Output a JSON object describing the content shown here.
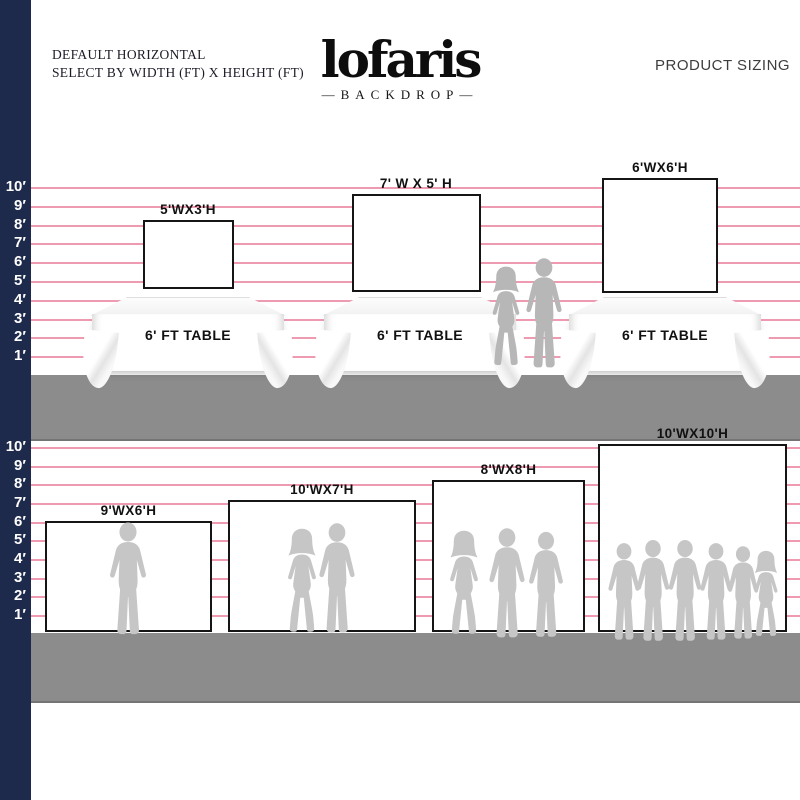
{
  "header": {
    "tagline_line1": "DEFAULT HORIZONTAL",
    "tagline_line2": "SELECT BY WIDTH (FT) X HEIGHT (FT)",
    "logo_text": "lofaris",
    "logo_sub": "—BACKDROP—",
    "right_label": "PRODUCT SIZING"
  },
  "ruler": {
    "unit": "ft",
    "labels": [
      "10′",
      "9′",
      "8′",
      "7′",
      "6′",
      "5′",
      "4′",
      "3′",
      "2′",
      "1′"
    ]
  },
  "colors": {
    "navy_bar": "#1e2a4c",
    "pink_line": "#ee9ab0",
    "floor_gray": "#8c8c8c",
    "silhouette_gray": "#c6c6c6",
    "silhouette_gray_dark": "#b7b7b7"
  },
  "top_section": {
    "table_label": "6' FT TABLE",
    "backdrops": [
      {
        "label": "5'WX3'H",
        "width_ft": 5,
        "height_ft": 3
      },
      {
        "label": "7' W X 5' H",
        "width_ft": 7,
        "height_ft": 5
      },
      {
        "label": "6'WX6'H",
        "width_ft": 6,
        "height_ft": 6
      }
    ]
  },
  "bottom_section": {
    "backdrops": [
      {
        "label": "9'WX6'H",
        "width_ft": 9,
        "height_ft": 6
      },
      {
        "label": "10'WX7'H",
        "width_ft": 10,
        "height_ft": 7
      },
      {
        "label": "8'WX8'H",
        "width_ft": 8,
        "height_ft": 8
      },
      {
        "label": "10'WX10'H",
        "width_ft": 10,
        "height_ft": 10
      }
    ]
  }
}
